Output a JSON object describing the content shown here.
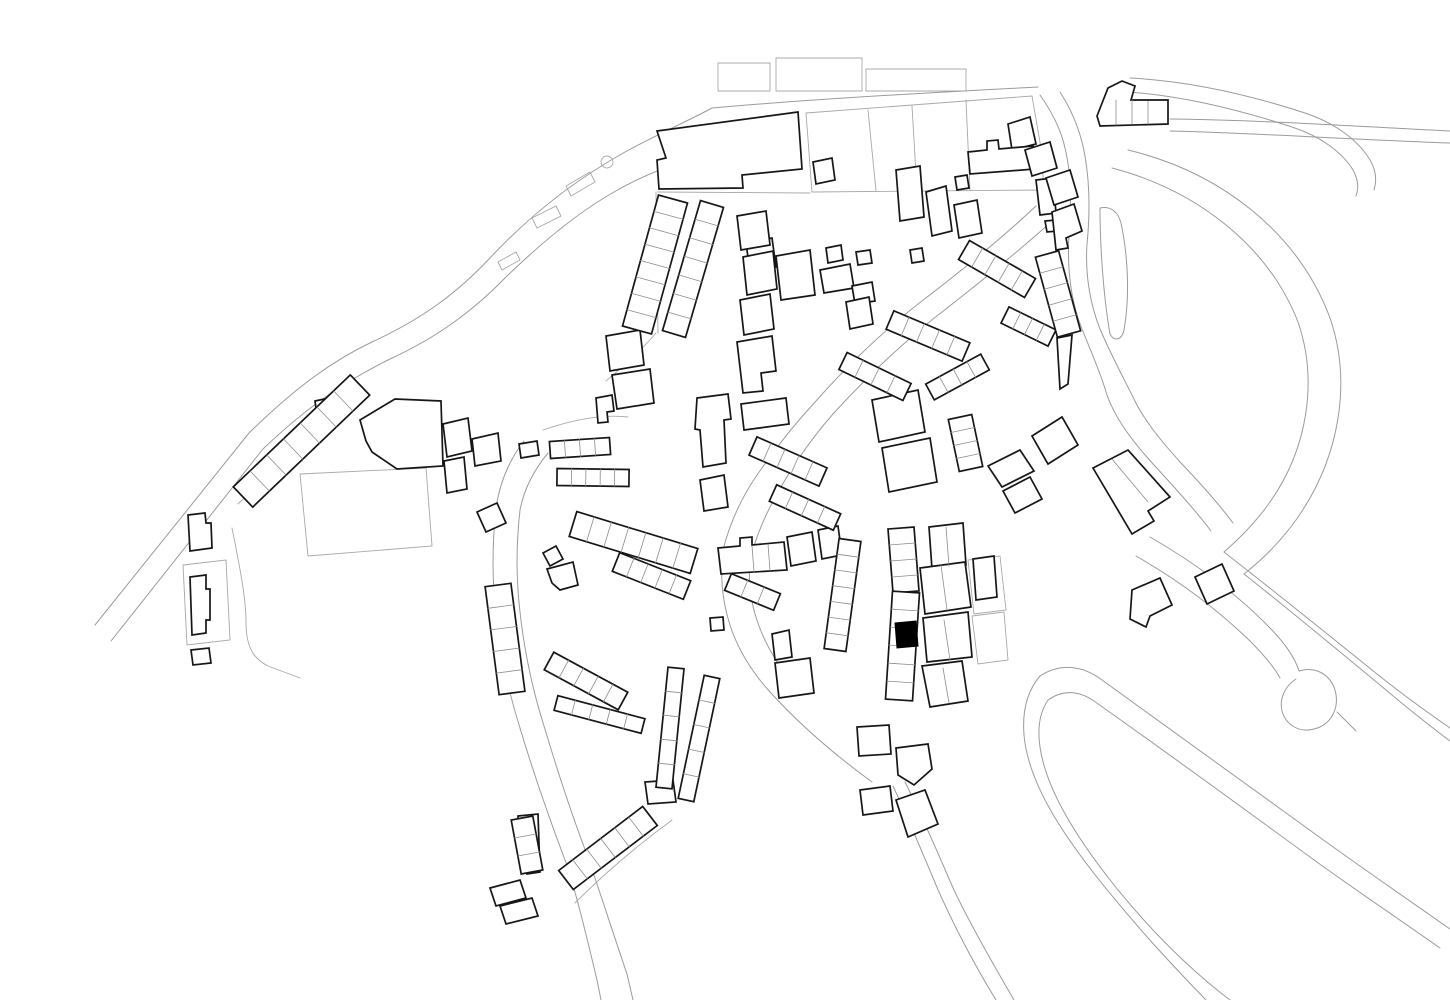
{
  "map": {
    "canvas": {
      "width": 1450,
      "height": 1000,
      "background": "#ffffff"
    },
    "styles": {
      "road_color": "#9b9b9b",
      "road_width": 1.0,
      "parcel_color": "#a8a8a8",
      "parcel_width": 0.9,
      "building_stroke": "#161616",
      "building_fill": "#ffffff",
      "building_width": 1.7,
      "division_color": "#8c8c8c",
      "division_width": 0.8,
      "highlight_fill": "#000000"
    },
    "roads": [
      "M95,625 L249,433 C297,386 334,360 372,342 C424,318 458,292 490,258 C530,215 575,180 625,152 C660,133 690,120 712,108",
      "M111,641 L263,449 C310,404 348,380 390,359 C438,337 474,310 505,278 C541,243 577,213 614,192 C640,177 664,167 690,160",
      "M712,108 C800,100 900,94 1038,87",
      "M1170,119 C1260,120 1350,126 1450,131",
      "M1170,131 C1255,133 1340,139 1450,143",
      "M1130,78 C1190,81 1250,95 1305,113 C1335,123 1358,140 1370,160 C1376,170 1377,180 1374,190",
      "M1128,92 C1185,96 1240,110 1292,127 C1320,136 1342,152 1353,170 C1358,179 1359,188 1356,196",
      "M1040,95 C1052,112 1060,128 1064,144 C1071,170 1072,200 1069,234 C1067,267 1070,299 1082,329 C1092,354 1101,374 1106,392 C1114,417 1132,441 1154,465 C1176,489 1196,511 1211,531",
      "M1060,92 C1073,112 1081,133 1085,156 C1090,185 1090,214 1087,244 C1085,274 1090,304 1100,329 C1112,357 1124,379 1133,397 C1143,419 1161,441 1181,463 C1201,484 1219,504 1233,523",
      "M1036,206 C1000,240 960,272 918,304 C880,334 846,367 816,401 C791,428 771,454 753,481 C739,503 729,526 723,550",
      "M1050,223 C1013,256 973,288 933,319 C896,349 863,381 833,414 C811,439 792,467 777,494 C764,517 755,539 750,561",
      "M1128,150 C1220,172 1298,232 1330,318 C1352,382 1340,458 1296,520 C1280,542 1262,560 1244,574",
      "M1112,168 C1196,190 1268,245 1298,322 C1318,380 1308,448 1270,502 C1256,522 1240,538 1224,552",
      "M1100,208 C1110,206 1118,211 1121,223 C1128,256 1130,296 1124,330 C1122,340 1114,342 1110,334 C1104,300 1100,250 1100,208 Z",
      "M1244,574 C1292,612 1344,655 1398,700 C1416,715 1434,729 1450,741",
      "M1224,552 C1270,588 1320,628 1372,670 C1398,691 1424,710 1450,728",
      "M1150,537 C1192,561 1236,593 1268,626 C1285,643 1295,658 1299,671",
      "M1136,556 C1178,580 1218,610 1250,641 C1264,655 1274,667 1280,678",
      "M1299,671 C1315,666 1330,674 1335,690 C1340,708 1331,725 1314,729 C1299,733 1286,725 1282,711 C1279,699 1285,686 1296,679",
      "M1337,712 L1356,731",
      "M1040,676 C1060,663 1082,665 1102,680 C1162,723 1242,781 1322,839 C1365,870 1410,901 1450,929",
      "M1048,700 C1062,690 1078,690 1094,701 C1152,742 1232,800 1310,857 C1351,887 1396,917 1440,948",
      "M1040,676 C1028,690 1022,710 1024,735 C1028,781 1060,831 1100,881 C1140,931 1176,969 1206,1000",
      "M1048,700 C1040,712 1037,727 1040,747 C1046,789 1076,837 1114,885 C1151,931 1188,968 1230,1000",
      "M905,782 C920,812 935,846 950,881 C962,909 986,952 1014,1000",
      "M893,786 C907,816 921,849 936,885 C948,913 969,956 996,1000",
      "M496,508 C492,545 492,580 496,615 C500,650 508,690 520,728 C532,768 548,815 565,860 C575,888 586,934 597,980 L601,1000",
      "M520,510 C516,545 516,578 520,612 C524,648 532,688 544,726 C556,766 570,810 586,852 C596,880 611,927 627,974 L633,1000",
      "M496,508 C500,481 510,459 524,441",
      "M520,510 C524,489 534,470 548,453",
      "M723,550 C720,575 722,600 730,625 C738,650 752,672 770,692",
      "M750,561 C748,583 751,605 759,626 C767,648 780,668 796,687",
      "M770,692 C800,725 835,755 872,782"
    ],
    "parcels": [
      "M806,113 L1032,96 L1041,148 L1044,190 L812,192 Z",
      "M868,110 L876,191",
      "M912,106 L917,191",
      "M966,100 L970,190",
      "M718,63 L770,63 L770,91 L718,91 Z",
      "M776,58 L862,58 L862,91 L776,91 Z",
      "M866,69 L966,69 L966,91 L866,91 Z",
      "M300,474 L426,468 L432,546 L308,556 Z",
      "M183,565 L226,560 L230,640 L187,645 Z",
      "M575,903 C610,868 642,842 672,820",
      "M968,560 L1000,556 L1006,610 L974,614 Z",
      "M972,616 L1004,612 L1008,660 L978,664 Z",
      "M601,162 a6,6 0 1 0 12,0 a6,6 0 1 0 -12,0",
      "M532,218 L556,206 L561,216 L537,228 Z",
      "M566,186 L590,172 L595,182 L571,196 Z",
      "M498,262 L516,252 L520,260 L502,270 Z",
      "M658,192 L810,193",
      "M656,192 L658,333",
      "M656,333 C640,352 622,367 606,381",
      "M238,504 L356,391",
      "M232,528 C240,568 246,598 246,622 C246,645 252,658 268,666 L300,678",
      "M543,430 C572,420 602,414 628,417"
    ],
    "buildings": [
      "M657,131 L798,112 L802,169 L742,175 L743,188 L659,189 L657,160 L666,158 Z",
      "M1008,124 L1030,117 L1036,144 L1012,150 Z",
      "M968,152 L987,150 L987,141 L998,140 L999,149 L1033,146 L1035,169 L970,174 Z",
      "M955,177 L967,175 L969,188 L957,190 Z",
      "M954,205 L977,200 L982,233 L959,238 Z",
      "M1036,180 L1053,178 L1056,213 L1040,215 Z",
      "M1045,221 L1056,220 L1058,231 L1047,232 Z",
      "M910,250 L922,248 L924,261 L912,263 Z",
      "M896,170 L920,166 L924,217 L900,221 Z",
      "M926,192 L946,186 L952,231 L932,236 Z",
      "M813,162 L832,158 L835,180 L816,184 Z",
      "M1097,116 L1108,88 L1122,81 L1135,86 L1131,100 L1168,100 L1168,124 L1100,126 Z",
      "M1025,150 L1050,142 L1057,168 L1032,176 Z",
      "M1046,178 L1070,170 L1078,197 L1054,205 Z",
      "M1052,212 L1074,204 L1082,231 L1066,238 L1068,248 L1056,250 Z",
      "M1057,338 L1072,335 L1068,384 L1060,389 Z",
      "M746,243 L772,238 L776,267 L750,272 Z",
      "M776,256 L810,250 L815,295 L781,300 Z",
      "M820,270 L850,264 L854,288 L824,293 Z",
      "M852,286 L872,282 L875,301 L855,304 Z",
      "M856,252 L870,250 L872,263 L858,265 Z",
      "M826,248 L841,245 L843,260 L828,263 Z",
      "M846,302 L869,297 L873,324 L850,329 Z",
      "M737,216 L766,211 L770,245 L741,250 Z",
      "M743,257 L773,251 L777,289 L747,295 Z",
      "M740,300 L770,294 L774,329 L744,335 Z",
      "M737,342 L772,336 L776,371 L761,373 L763,391 L743,393 Z",
      "M606,336 L640,330 L644,365 L610,371 Z",
      "M612,375 L650,369 L654,403 L617,409 Z",
      "M596,398 L612,395 L614,411 L607,412 L608,422 L598,423 Z",
      "M697,398 L728,394 L731,419 L724,420 L726,463 L703,467 L700,430 L695,429 Z",
      "M741,404 L786,398 L789,424 L744,430 Z",
      "M700,480 L724,475 L728,507 L704,511 Z",
      "M718,548 L740,546 L740,538 L752,537 L752,545 L784,542 L787,570 L721,574 Z",
      "M710,618 L723,617 L724,630 L711,631 Z",
      "M787,537 L812,532 L816,561 L791,566 Z",
      "M818,530 L838,526 L842,555 L822,559 Z",
      "M872,400 L918,390 L925,432 L879,442 Z",
      "M882,448 L930,438 L937,482 L889,492 Z",
      "M988,466 L1020,450 L1034,471 L1002,487 Z",
      "M1003,491 L1030,477 L1042,499 L1015,513 Z",
      "M1032,436 L1062,417 L1078,445 L1048,464 Z",
      "M1093,468 L1128,450 L1170,497 L1148,511 L1154,521 L1132,534 Z",
      "M1195,577 L1222,564 L1234,591 L1207,604 Z",
      "M1132,590 L1160,578 L1172,605 L1150,616 L1146,627 L1130,619 Z",
      "M929,527 L963,523 L966,565 L932,569 Z",
      "M920,568 L965,562 L971,607 L925,614 Z",
      "M923,618 L968,612 L972,657 L927,662 Z",
      "M922,666 L962,661 L968,701 L930,707 Z",
      "M973,559 L994,556 L997,597 L976,600 Z",
      "M857,727 L889,725 L891,754 L859,756 Z",
      "M896,748 L928,744 L932,769 L914,785 L898,775 Z",
      "M860,790 L890,786 L893,811 L863,815 Z",
      "M896,800 L925,790 L938,824 L908,837 Z",
      "M772,634 L789,630 L792,657 L775,660 Z",
      "M775,663 L810,658 L814,693 L779,698 Z",
      "M477,512 L497,503 L506,523 L486,532 Z",
      "M443,424 L468,418 L472,451 L447,457 Z",
      "M472,439 L498,433 L501,461 L475,466 Z",
      "M444,461 L464,457 L467,489 L447,493 Z",
      "M519,444 L537,441 L539,455 L521,458 Z",
      "M518,816 L538,814 L540,872 L527,874 L526,860 L519,858 Z",
      "M490,888 L520,880 L526,898 L496,906 Z",
      "M500,906 L532,898 L538,916 L506,924 Z",
      "M645,782 L673,780 L676,802 L648,804 Z",
      "M188,515 L205,513 L206,523 L211,523 L212,548 L190,551 Z",
      "M190,577 L206,575 L206,589 L210,589 L210,620 L206,620 L206,633 L192,635 Z",
      "M191,650 L209,648 L211,663 L193,665 Z",
      "M360,420 L395,399 L441,401 L443,466 L397,469 L372,452 L366,441 Z",
      "M315,401 L329,398 L331,413 L317,416 Z",
      "M543,553 L556,546 L563,559 L550,566 Z",
      "M547,569 L573,562 L578,585 L560,590 L552,583 Z"
    ],
    "ladders": [
      {
        "a": [
          243,
          497
        ],
        "b": [
          360,
          385
        ],
        "w": 28,
        "n": 7
      },
      {
        "a": [
          498,
          585
        ],
        "b": [
          512,
          693
        ],
        "w": 26,
        "n": 5
      },
      {
        "a": [
          522,
          818
        ],
        "b": [
          532,
          872
        ],
        "w": 22,
        "n": 3
      },
      {
        "a": [
          566,
          880
        ],
        "b": [
          650,
          816
        ],
        "w": 24,
        "n": 6
      },
      {
        "a": [
          549,
          661
        ],
        "b": [
          623,
          701
        ],
        "w": 20,
        "n": 5
      },
      {
        "a": [
          556,
          703
        ],
        "b": [
          643,
          726
        ],
        "w": 15,
        "n": 5
      },
      {
        "a": [
          550,
          450
        ],
        "b": [
          610,
          446
        ],
        "w": 17,
        "n": 4
      },
      {
        "a": [
          557,
          477
        ],
        "b": [
          629,
          478
        ],
        "w": 17,
        "n": 5
      },
      {
        "a": [
          573,
          524
        ],
        "b": [
          694,
          561
        ],
        "w": 26,
        "n": 7
      },
      {
        "a": [
          616,
          562
        ],
        "b": [
          687,
          590
        ],
        "w": 20,
        "n": 5
      },
      {
        "a": [
          673,
          199
        ],
        "b": [
          637,
          330
        ],
        "w": 30,
        "n": 8
      },
      {
        "a": [
          712,
          204
        ],
        "b": [
          674,
          334
        ],
        "w": 24,
        "n": 7
      },
      {
        "a": [
          964,
          250
        ],
        "b": [
          1030,
          288
        ],
        "w": 22,
        "n": 5
      },
      {
        "a": [
          1005,
          315
        ],
        "b": [
          1052,
          338
        ],
        "w": 18,
        "n": 4
      },
      {
        "a": [
          890,
          320
        ],
        "b": [
          966,
          352
        ],
        "w": 20,
        "n": 5
      },
      {
        "a": [
          843,
          361
        ],
        "b": [
          907,
          392
        ],
        "w": 19,
        "n": 4
      },
      {
        "a": [
          1047,
          254
        ],
        "b": [
          1069,
          334
        ],
        "w": 24,
        "n": 5
      },
      {
        "a": [
          960,
          417
        ],
        "b": [
          971,
          469
        ],
        "w": 24,
        "n": 4
      },
      {
        "a": [
          850,
          540
        ],
        "b": [
          835,
          650
        ],
        "w": 22,
        "n": 7
      },
      {
        "a": [
          901,
          528
        ],
        "b": [
          906,
          592
        ],
        "w": 26,
        "n": 4
      },
      {
        "a": [
          906,
          592
        ],
        "b": [
          899,
          700
        ],
        "w": 27,
        "n": 6
      },
      {
        "a": [
          930,
          392
        ],
        "b": [
          985,
          362
        ],
        "w": 18,
        "n": 4
      },
      {
        "a": [
          728,
          582
        ],
        "b": [
          777,
          602
        ],
        "w": 18,
        "n": 3
      },
      {
        "a": [
          753,
          446
        ],
        "b": [
          823,
          477
        ],
        "w": 20,
        "n": 5
      },
      {
        "a": [
          773,
          493
        ],
        "b": [
          837,
          522
        ],
        "w": 18,
        "n": 4
      },
      {
        "a": [
          676,
          668
        ],
        "b": [
          664,
          788
        ],
        "w": 16,
        "n": 5
      },
      {
        "a": [
          712,
          677
        ],
        "b": [
          686,
          800
        ],
        "w": 16,
        "n": 5
      }
    ],
    "divisions": [
      "M752,546 L754,572",
      "M768,544 L770,571",
      "M946,527 L949,566",
      "M941,565 L947,610",
      "M944,620 L950,660",
      "M943,668 L949,703",
      "M1112,459 L1148,502",
      "M1116,100 L1116,125",
      "M1132,100 L1132,124",
      "M1148,101 L1148,124"
    ],
    "highlight_building": "M895,623 L916,621 L918,646 L897,648 Z"
  }
}
